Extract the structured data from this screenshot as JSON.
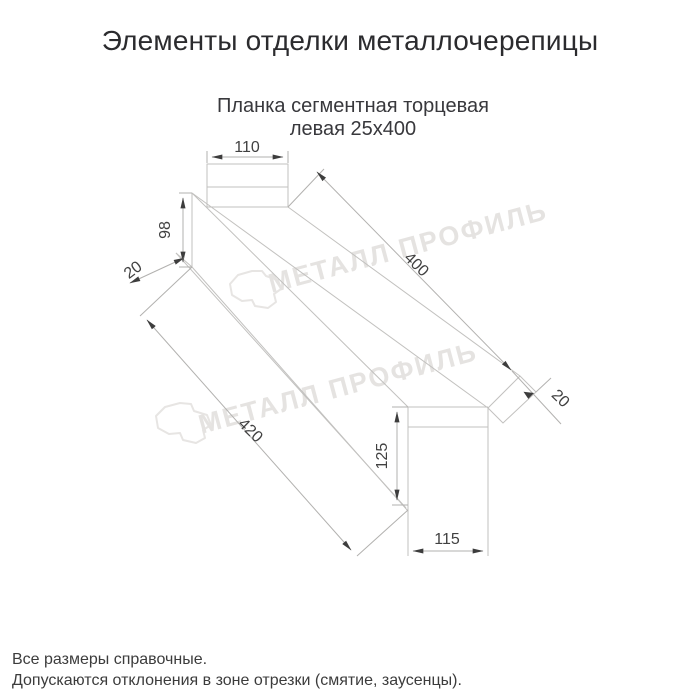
{
  "page": {
    "title": "Элементы отделки металлочерепицы"
  },
  "product": {
    "title_line1": "Планка сегментная торцевая",
    "title_line2": "левая 25х400"
  },
  "drawing": {
    "dims": {
      "top_width": "110",
      "left_height": "98",
      "left_hem": "20",
      "length": "400",
      "right_hem": "20",
      "bottom_length": "420",
      "right_height": "125",
      "right_width": "115"
    }
  },
  "watermark": {
    "text": "МЕТАЛЛ ПРОФИЛЬ"
  },
  "footnotes": {
    "line1": "Все размеры справочные.",
    "line2": "Допускаются отклонения в зоне отрезки (смятие, заусенцы)."
  },
  "colors": {
    "object_line": "#c2c1bf",
    "dimension_line": "#b2b1af",
    "dimension_text": "#414141",
    "watermark": "#e5e3e1",
    "title_text": "#2b2b2e"
  }
}
